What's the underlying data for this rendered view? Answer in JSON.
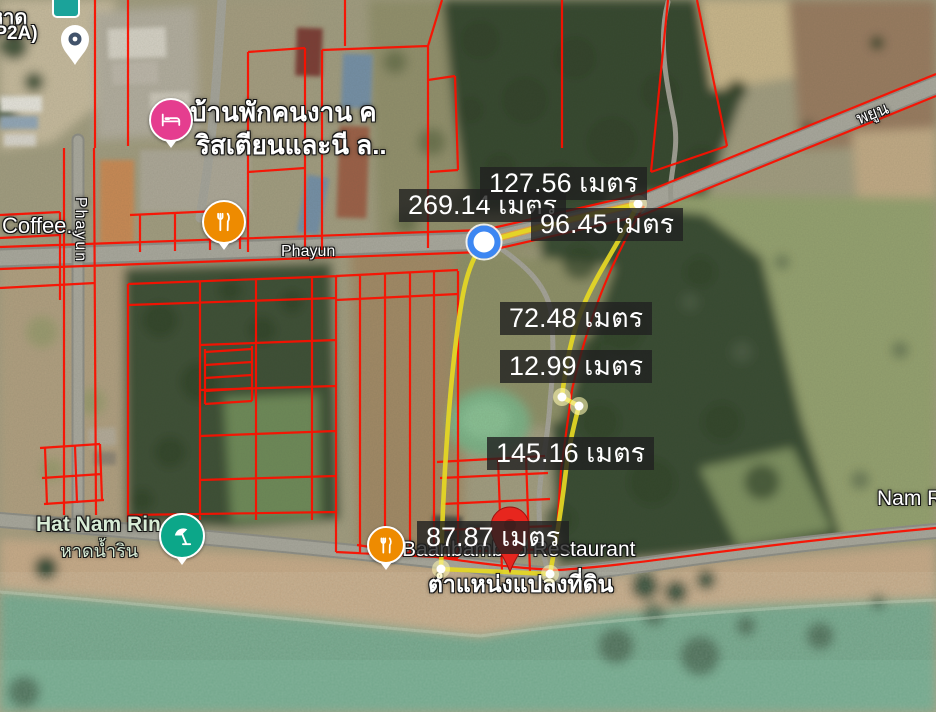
{
  "app": {
    "view": "satellite-map-land-plot-measurement"
  },
  "map": {
    "unit_word": "เมตร",
    "measurements": [
      {
        "value": "269.14",
        "text": "269.14 เมตร"
      },
      {
        "value": "127.56",
        "text": "127.56 เมตร"
      },
      {
        "value": "96.45",
        "text": "96.45 เมตร"
      },
      {
        "value": "72.48",
        "text": "72.48 เมตร"
      },
      {
        "value": "12.99",
        "text": "12.99 เมตร"
      },
      {
        "value": "145.16",
        "text": "145.16 เมตร"
      },
      {
        "value": "87.87",
        "text": "87.87 เมตร"
      }
    ],
    "markers": {
      "parcel_pin_caption": "ตำแหน่งแปลงที่ดิน"
    },
    "places": {
      "restaurant": "Baanbamboo Restaurant",
      "beach_en": "Hat Nam Rin",
      "beach_th": "หาดน้ำริน",
      "worker_house_line1": "บ้านพักคนงาน ค",
      "worker_house_line2": "ริสเตียนและนี ล..",
      "coffee": "Coffee..",
      "top_left_line1": "หาด",
      "top_left_line2": "(P2A)",
      "nam_r": "Nam R"
    },
    "roads": {
      "phayun_horizontal": "Phayun",
      "phayun_vertical": "Phayun",
      "phayun_thai": "พยูน"
    },
    "colors": {
      "parcel_line_red": "#fa1000",
      "plot_boundary_yellow": "#e5d723",
      "measure_segment_orange": "#f49b26",
      "vertex_marker_blue": "#3d87f2",
      "location_pin_red": "#e7261e",
      "restaurant_orange": "#ee8b00",
      "lodging_pink": "#e53d8f",
      "beach_teal": "#0ca789",
      "sea_green": "#73a78c",
      "label_box_bg": "rgba(33,33,33,0.8)"
    }
  }
}
